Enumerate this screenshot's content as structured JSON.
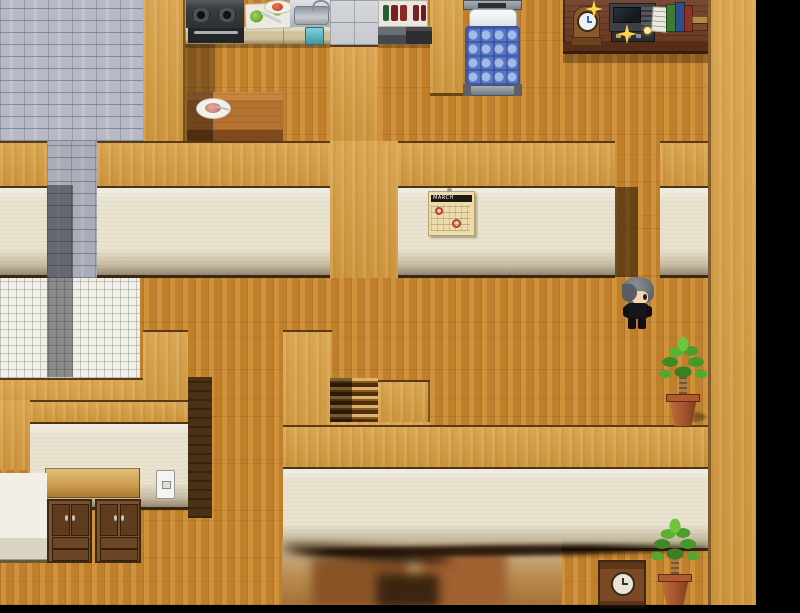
{
  "meta": {
    "app": "rpg-maker-style-game",
    "view": "house-interior-map-viewport"
  },
  "calendar": {
    "month_label": "MARCH"
  },
  "character": {
    "id": "player-sprite",
    "hair": "gray",
    "outfit": "black",
    "facing": "right"
  },
  "palette": {
    "floor_wood": "#c8862e",
    "wall_orange": "#d69c40",
    "wall_face_beige": "#e8e2cf",
    "stone_floor": "#b7bac6",
    "white_tile": "#f0efe9",
    "desk_wood": "#6b3a22",
    "bed_blue": "#5575c5",
    "leaf_green": "#4f9c2e",
    "pot_clay": "#a2522c",
    "void_black": "#000000",
    "sparkle_gold": "#ffd84a"
  },
  "objects": {
    "kitchen": [
      "stove",
      "oven",
      "cutting-board",
      "tomato-plate",
      "sink",
      "counter",
      "water-bin",
      "stone-blocks",
      "bottle-shelf",
      "dark-counter",
      "dining-table",
      "food-plate"
    ],
    "bedroom": [
      "bed",
      "pillow"
    ],
    "study": [
      "desk",
      "mantel-clock",
      "radio-device",
      "papers",
      "books",
      "sparkles"
    ],
    "hall": [
      "wall-calendar",
      "player-sprite",
      "potted-plant",
      "stairs"
    ],
    "storage_room": [
      "cabinet-left",
      "cabinet-right",
      "white-counter",
      "light-switch"
    ],
    "lower_room": [
      "floor-clock",
      "potted-plant",
      "blurred-furniture"
    ]
  }
}
